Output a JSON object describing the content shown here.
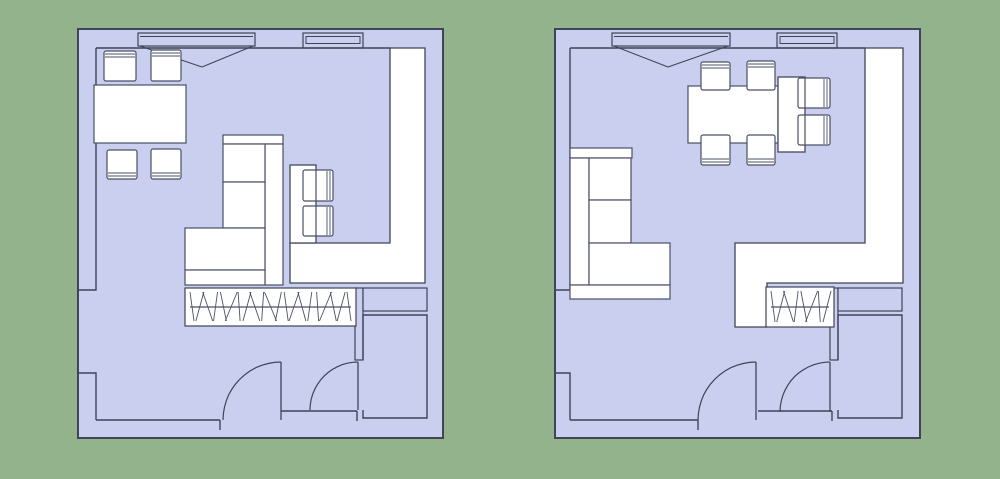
{
  "scene": {
    "width": 1000,
    "height": 479,
    "background": "#93b38c",
    "palette": {
      "floor": "#cacfef",
      "white": "#ffffff",
      "wall": "#3f4457",
      "furn": "#4a5066"
    },
    "hatch_slants": [
      2,
      -4,
      5,
      -2,
      3,
      -6,
      1,
      -4,
      5,
      -1,
      6,
      -3,
      2,
      -5,
      4,
      -2,
      1,
      -6,
      3,
      -4,
      2
    ]
  },
  "plans": [
    {
      "name": "floor-plan-option-1",
      "shapes": [
        {
          "k": "rect",
          "n": "exterior-wall",
          "x": 78,
          "y": 29,
          "w": 365,
          "h": 409,
          "f": "floor",
          "s": "wall",
          "lw": 2
        },
        {
          "k": "line",
          "n": "interior-wall-top",
          "x1": 96,
          "y1": 48,
          "x2": 390,
          "y2": 48
        },
        {
          "k": "pline",
          "n": "interior-wall-left",
          "pts": [
            [
              96,
              48
            ],
            [
              96,
              290
            ],
            [
              78,
              290
            ]
          ]
        },
        {
          "k": "pline",
          "n": "interior-wall-left-lower",
          "pts": [
            [
              78,
              373
            ],
            [
              96,
              373
            ],
            [
              96,
              420
            ]
          ]
        },
        {
          "k": "line",
          "n": "interior-wall-bottom-left",
          "x1": 96,
          "y1": 420,
          "x2": 220,
          "y2": 420
        },
        {
          "k": "line",
          "n": "interior-wall-bottom-mid",
          "x1": 281,
          "y1": 411,
          "x2": 357,
          "y2": 411
        },
        {
          "k": "line",
          "n": "door-jamb",
          "x1": 220,
          "y1": 420,
          "x2": 220,
          "y2": 430
        },
        {
          "k": "line",
          "n": "door-jamb",
          "x1": 357,
          "y1": 411,
          "x2": 357,
          "y2": 421
        },
        {
          "k": "poly",
          "n": "adjacent-area",
          "f": "white",
          "pts": [
            [
              390,
              48
            ],
            [
              425,
              48
            ],
            [
              425,
              283
            ],
            [
              290,
              283
            ],
            [
              290,
              243
            ],
            [
              390,
              243
            ]
          ]
        },
        {
          "k": "rect",
          "n": "wall-stub",
          "x": 355,
          "y": 288,
          "w": 8,
          "h": 72,
          "f": "floor",
          "s": "wall"
        },
        {
          "k": "rect",
          "n": "wall-niche",
          "x": 363,
          "y": 288,
          "w": 64,
          "h": 23,
          "f": "floor",
          "s": "wall"
        },
        {
          "k": "path",
          "n": "small-room-walls",
          "d": "M363,410 L363,418 L427,418 L427,315 L363,315 L363,360"
        },
        {
          "k": "hatch",
          "n": "radiator",
          "x": 185,
          "y": 288,
          "w": 171,
          "h": 38,
          "nl": 21
        },
        {
          "k": "winA",
          "n": "casement-window",
          "x": 138,
          "y": 33,
          "w": 117,
          "h": 13,
          "ax": 202,
          "ay": 67
        },
        {
          "k": "winB",
          "n": "fixed-window",
          "x": 303,
          "y": 33,
          "w": 60,
          "h": 15
        },
        {
          "k": "door",
          "n": "door-swing",
          "hx": 281,
          "hy": 420,
          "r": 58
        },
        {
          "k": "door",
          "n": "door-swing",
          "hx": 358,
          "hy": 410,
          "r": 48
        },
        {
          "k": "rect",
          "n": "dining-table",
          "x": 94,
          "y": 85,
          "w": 92,
          "h": 58,
          "f": "white",
          "s": "furn"
        },
        {
          "k": "chair",
          "n": "dining-chair",
          "x": 104,
          "y": 51,
          "w": 32,
          "h": 30,
          "side": "top"
        },
        {
          "k": "chair",
          "n": "dining-chair",
          "x": 151,
          "y": 50,
          "w": 30,
          "h": 31,
          "side": "top"
        },
        {
          "k": "chair",
          "n": "dining-chair",
          "x": 107,
          "y": 150,
          "w": 30,
          "h": 29,
          "side": "bottom"
        },
        {
          "k": "chair",
          "n": "dining-chair",
          "x": 151,
          "y": 149,
          "w": 30,
          "h": 30,
          "side": "bottom"
        },
        {
          "k": "rect",
          "n": "desk",
          "x": 290,
          "y": 165,
          "w": 26,
          "h": 78,
          "f": "white",
          "s": "furn"
        },
        {
          "k": "chair",
          "n": "desk-chair",
          "x": 303,
          "y": 170,
          "w": 30,
          "h": 31,
          "side": "right"
        },
        {
          "k": "chair",
          "n": "desk-chair",
          "x": 303,
          "y": 206,
          "w": 30,
          "h": 30,
          "side": "right"
        },
        {
          "k": "rect",
          "n": "desk-outline",
          "x": 290,
          "y": 165,
          "w": 26,
          "h": 78,
          "s": "furn"
        },
        {
          "k": "rect",
          "n": "sofa-armrest",
          "x": 223,
          "y": 135,
          "w": 60,
          "h": 9,
          "f": "white",
          "s": "furn"
        },
        {
          "k": "rect",
          "n": "sofa-back",
          "x": 265,
          "y": 144,
          "w": 18,
          "h": 141,
          "f": "white",
          "s": "furn"
        },
        {
          "k": "rect",
          "n": "sofa-cushion",
          "x": 223,
          "y": 144,
          "w": 42,
          "h": 38,
          "f": "white",
          "s": "furn"
        },
        {
          "k": "rect",
          "n": "sofa-cushion",
          "x": 223,
          "y": 182,
          "w": 42,
          "h": 46,
          "f": "white",
          "s": "furn"
        },
        {
          "k": "rect",
          "n": "sofa-chaise",
          "x": 185,
          "y": 228,
          "w": 80,
          "h": 42,
          "f": "white",
          "s": "furn"
        },
        {
          "k": "rect",
          "n": "sofa-armrest",
          "x": 185,
          "y": 270,
          "w": 80,
          "h": 15,
          "f": "white",
          "s": "furn"
        }
      ]
    },
    {
      "name": "floor-plan-option-2",
      "shapes": [
        {
          "k": "rect",
          "n": "exterior-wall",
          "x": 555,
          "y": 29,
          "w": 365,
          "h": 409,
          "f": "floor",
          "s": "wall",
          "lw": 2
        },
        {
          "k": "line",
          "n": "interior-wall-top",
          "x1": 570,
          "y1": 48,
          "x2": 865,
          "y2": 48
        },
        {
          "k": "pline",
          "n": "interior-wall-left",
          "pts": [
            [
              570,
              48
            ],
            [
              570,
              290
            ],
            [
              555,
              290
            ]
          ]
        },
        {
          "k": "pline",
          "n": "interior-wall-left-lower",
          "pts": [
            [
              555,
              373
            ],
            [
              570,
              373
            ],
            [
              570,
              420
            ]
          ]
        },
        {
          "k": "line",
          "n": "interior-wall-bottom-left",
          "x1": 570,
          "y1": 420,
          "x2": 698,
          "y2": 420
        },
        {
          "k": "line",
          "n": "interior-wall-bottom-mid",
          "x1": 758,
          "y1": 411,
          "x2": 832,
          "y2": 411
        },
        {
          "k": "line",
          "n": "door-jamb",
          "x1": 698,
          "y1": 420,
          "x2": 698,
          "y2": 430
        },
        {
          "k": "line",
          "n": "door-jamb",
          "x1": 832,
          "y1": 411,
          "x2": 832,
          "y2": 421
        },
        {
          "k": "poly",
          "n": "adjacent-area",
          "f": "white",
          "pts": [
            [
              865,
              48
            ],
            [
              903,
              48
            ],
            [
              903,
              283
            ],
            [
              767,
              283
            ],
            [
              767,
              327
            ],
            [
              735,
              327
            ],
            [
              735,
              243
            ],
            [
              865,
              243
            ]
          ]
        },
        {
          "k": "rect",
          "n": "wall-stub",
          "x": 830,
          "y": 288,
          "w": 8,
          "h": 72,
          "f": "floor",
          "s": "wall"
        },
        {
          "k": "rect",
          "n": "wall-niche",
          "x": 838,
          "y": 288,
          "w": 64,
          "h": 23,
          "f": "floor",
          "s": "wall"
        },
        {
          "k": "path",
          "n": "small-room-walls",
          "d": "M838,410 L838,418 L902,418 L902,315 L838,315 L838,360"
        },
        {
          "k": "hatch",
          "n": "radiator",
          "x": 766,
          "y": 287,
          "w": 68,
          "h": 40,
          "nl": 8
        },
        {
          "k": "winA",
          "n": "casement-window",
          "x": 612,
          "y": 33,
          "w": 118,
          "h": 13,
          "ax": 668,
          "ay": 67
        },
        {
          "k": "winB",
          "n": "fixed-window",
          "x": 777,
          "y": 33,
          "w": 60,
          "h": 15
        },
        {
          "k": "door",
          "n": "door-swing",
          "hx": 756,
          "hy": 420,
          "r": 58
        },
        {
          "k": "door",
          "n": "door-swing",
          "hx": 830,
          "hy": 412,
          "r": 50
        },
        {
          "k": "rect",
          "n": "dining-table",
          "x": 688,
          "y": 86,
          "w": 90,
          "h": 57,
          "f": "white",
          "s": "furn"
        },
        {
          "k": "rect",
          "n": "desk",
          "x": 778,
          "y": 77,
          "w": 27,
          "h": 75,
          "f": "white",
          "s": "furn"
        },
        {
          "k": "chair",
          "n": "dining-chair",
          "x": 701,
          "y": 62,
          "w": 29,
          "h": 28,
          "side": "top"
        },
        {
          "k": "chair",
          "n": "dining-chair",
          "x": 747,
          "y": 61,
          "w": 28,
          "h": 29,
          "side": "top"
        },
        {
          "k": "chair",
          "n": "dining-chair",
          "x": 701,
          "y": 135,
          "w": 29,
          "h": 30,
          "side": "bottom"
        },
        {
          "k": "chair",
          "n": "dining-chair",
          "x": 747,
          "y": 135,
          "w": 28,
          "h": 30,
          "side": "bottom"
        },
        {
          "k": "chair",
          "n": "desk-chair",
          "x": 798,
          "y": 78,
          "w": 32,
          "h": 30,
          "side": "right"
        },
        {
          "k": "chair",
          "n": "desk-chair",
          "x": 798,
          "y": 115,
          "w": 32,
          "h": 30,
          "side": "right"
        },
        {
          "k": "rect",
          "n": "desk-outline",
          "x": 778,
          "y": 77,
          "w": 27,
          "h": 75,
          "s": "furn"
        },
        {
          "k": "rect",
          "n": "sofa-armrest",
          "x": 570,
          "y": 148,
          "w": 62,
          "h": 10,
          "f": "white",
          "s": "furn"
        },
        {
          "k": "rect",
          "n": "sofa-back",
          "x": 570,
          "y": 158,
          "w": 19,
          "h": 127,
          "f": "white",
          "s": "furn"
        },
        {
          "k": "rect",
          "n": "sofa-cushion",
          "x": 589,
          "y": 158,
          "w": 42,
          "h": 42,
          "f": "white",
          "s": "furn"
        },
        {
          "k": "rect",
          "n": "sofa-cushion",
          "x": 589,
          "y": 200,
          "w": 42,
          "h": 43,
          "f": "white",
          "s": "furn"
        },
        {
          "k": "rect",
          "n": "sofa-chaise",
          "x": 589,
          "y": 243,
          "w": 81,
          "h": 42,
          "f": "white",
          "s": "furn"
        },
        {
          "k": "rect",
          "n": "sofa-armrest",
          "x": 570,
          "y": 285,
          "w": 100,
          "h": 14,
          "f": "white",
          "s": "furn"
        }
      ]
    }
  ]
}
